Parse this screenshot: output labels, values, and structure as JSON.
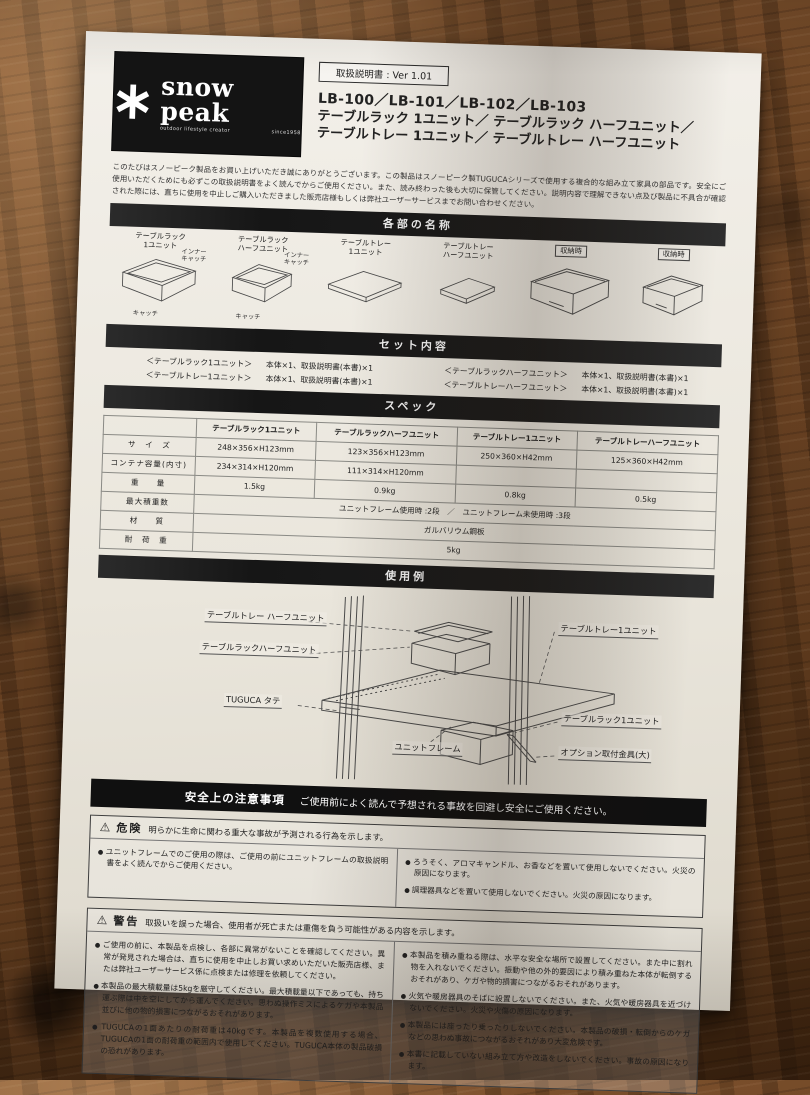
{
  "logo": {
    "brand": "snow peak",
    "tagline": "outdoor lifestyle creator",
    "since": "since1958"
  },
  "header": {
    "ver_box": "取扱説明書 : Ver 1.01",
    "models": "LB-100／LB-101／LB-102／LB-103",
    "title_line1": "テーブルラック 1ユニット／ テーブルラック ハーフユニット／",
    "title_line2": "テーブルトレー 1ユニット／ テーブルトレー ハーフユニット",
    "intro": "このたびはスノーピーク製品をお買い上げいただき誠にありがとうございます。この製品はスノーピーク製TUGUCAシリーズで使用する複合的な組み立て家具の部品です。安全にご使用いただくためにも必ずこの取扱説明書をよく読んでからご使用ください。また、読み終わった後も大切に保管してください。説明内容で理解できない点及び製品に不具合が確認された際には、直ちに使用を中止しご購入いただきました販売店様もしくは弊社ユーザーサービスまでお問い合わせください。"
  },
  "sections": {
    "parts": "各部の名称",
    "set": "セット内容",
    "spec": "スペック",
    "usage": "使用例"
  },
  "parts_list": {
    "items": [
      {
        "l1": "テーブルラック",
        "l2": "1ユニット"
      },
      {
        "l1": "テーブルラック",
        "l2": "ハーフユニット"
      },
      {
        "l1": "テーブルトレー",
        "l2": "1ユニット"
      },
      {
        "l1": "テーブルトレー",
        "l2": "ハーフユニット"
      }
    ],
    "stored_badge": "収納時",
    "inner_catch": "インナーキャッチ",
    "catch": "キャッチ"
  },
  "set_contents": {
    "rows": [
      {
        "name": "＜テーブルラック1ユニット＞",
        "qty": "本体×1、取扱説明書(本書)×1"
      },
      {
        "name": "＜テーブルラックハーフユニット＞",
        "qty": "本体×1、取扱説明書(本書)×1"
      },
      {
        "name": "＜テーブルトレー1ユニット＞",
        "qty": "本体×1、取扱説明書(本書)×1"
      },
      {
        "name": "＜テーブルトレーハーフユニット＞",
        "qty": "本体×1、取扱説明書(本書)×1"
      }
    ]
  },
  "spec": {
    "headers": [
      "テーブルラック1ユニット",
      "テーブルラックハーフユニット",
      "テーブルトレー1ユニット",
      "テーブルトレーハーフユニット"
    ],
    "row_size": {
      "label": "サ　イ　ズ",
      "v0": "248×356×H123mm",
      "v1": "123×356×H123mm",
      "v2": "250×360×H42mm",
      "v3": "125×360×H42mm"
    },
    "row_container": {
      "label": "コンテナ容量(内寸)",
      "v0": "234×314×H120mm",
      "v1": "111×314×H120mm",
      "v2": "",
      "v3": ""
    },
    "row_weight": {
      "label": "重　　量",
      "v0": "1.5kg",
      "v1": "0.9kg",
      "v2": "0.8kg",
      "v3": "0.5kg"
    },
    "row_stack": {
      "label": "最大積重数",
      "v": "ユニットフレーム使用時 :2段　／　ユニットフレーム未使用時 :3段"
    },
    "row_material": {
      "label": "材　　質",
      "v": "ガルバリウム鋼板"
    },
    "row_load": {
      "label": "耐　荷　重",
      "v": "5kg"
    }
  },
  "usage": {
    "tray_half": "テーブルトレー ハーフユニット",
    "rack_half": "テーブルラックハーフユニット",
    "tray_one": "テーブルトレー1ユニット",
    "tuguca": "TUGUCA タテ",
    "unit_frame": "ユニットフレーム",
    "rack_one": "テーブルラック1ユニット",
    "bracket": "オプション取付金具(大)"
  },
  "safety_bar": {
    "title": "安全上の注意事項",
    "subtitle": "ご使用前によく読んで予想される事故を回避し安全にご使用ください。"
  },
  "icons": {
    "warning_triangle": "⚠"
  },
  "danger": {
    "label": "危険",
    "desc": "明らかに生命に関わる重大な事故が予測される行為を示します。",
    "left": [
      "ユニットフレームでのご使用の際は、ご使用の前にユニットフレームの取扱説明書をよく読んでからご使用ください。"
    ],
    "right": [
      "ろうそく、アロマキャンドル、お香などを置いて使用しないでください。火災の原因になります。",
      "調理器具などを置いて使用しないでください。火災の原因になります。"
    ]
  },
  "warning": {
    "label": "警告",
    "desc": "取扱いを誤った場合、使用者が死亡または重傷を負う可能性がある内容を示します。",
    "left": [
      "ご使用の前に、本製品を点検し、各部に異常がないことを確認してください。異常が発見された場合は、直ちに使用を中止しお買い求めいただいた販売店様、または弊社ユーザーサービス係に点検または修理を依頼してください。",
      "本製品の最大積載量は5kgを厳守してください。最大積載量以下であっても、持ち運ぶ際は中を空にしてから運んでください。思わぬ操作ミスによるケガや本製品並びに他の物的損害につながるおそれがあります。",
      "TUGUCAの1面あたりの耐荷重は40kgです。本製品を複数使用する場合、TUGUCAの1面の耐荷重の範囲内で使用してください。TUGUCA本体の製品破損の恐れがあります。"
    ],
    "right": [
      "本製品を積み重ねる際は、水平な安全な場所で設置してください。また中に割れ物を入れないでください。振動や他の外的要因により積み重ねた本体が転倒するおそれがあり、ケガや物的損害につながるおそれがあります。",
      "火気や暖房器具のそばに設置しないでください。また、火気や暖房器具を近づけないでください。火災や火傷の原因になります。",
      "本製品には座ったり乗ったりしないでください。本製品の破損・転倒からのケガなどの思わぬ事故につながるおそれがあり大変危険です。",
      "本書に記載していない組み立て方や改造をしないでください。事故の原因になります。"
    ]
  }
}
